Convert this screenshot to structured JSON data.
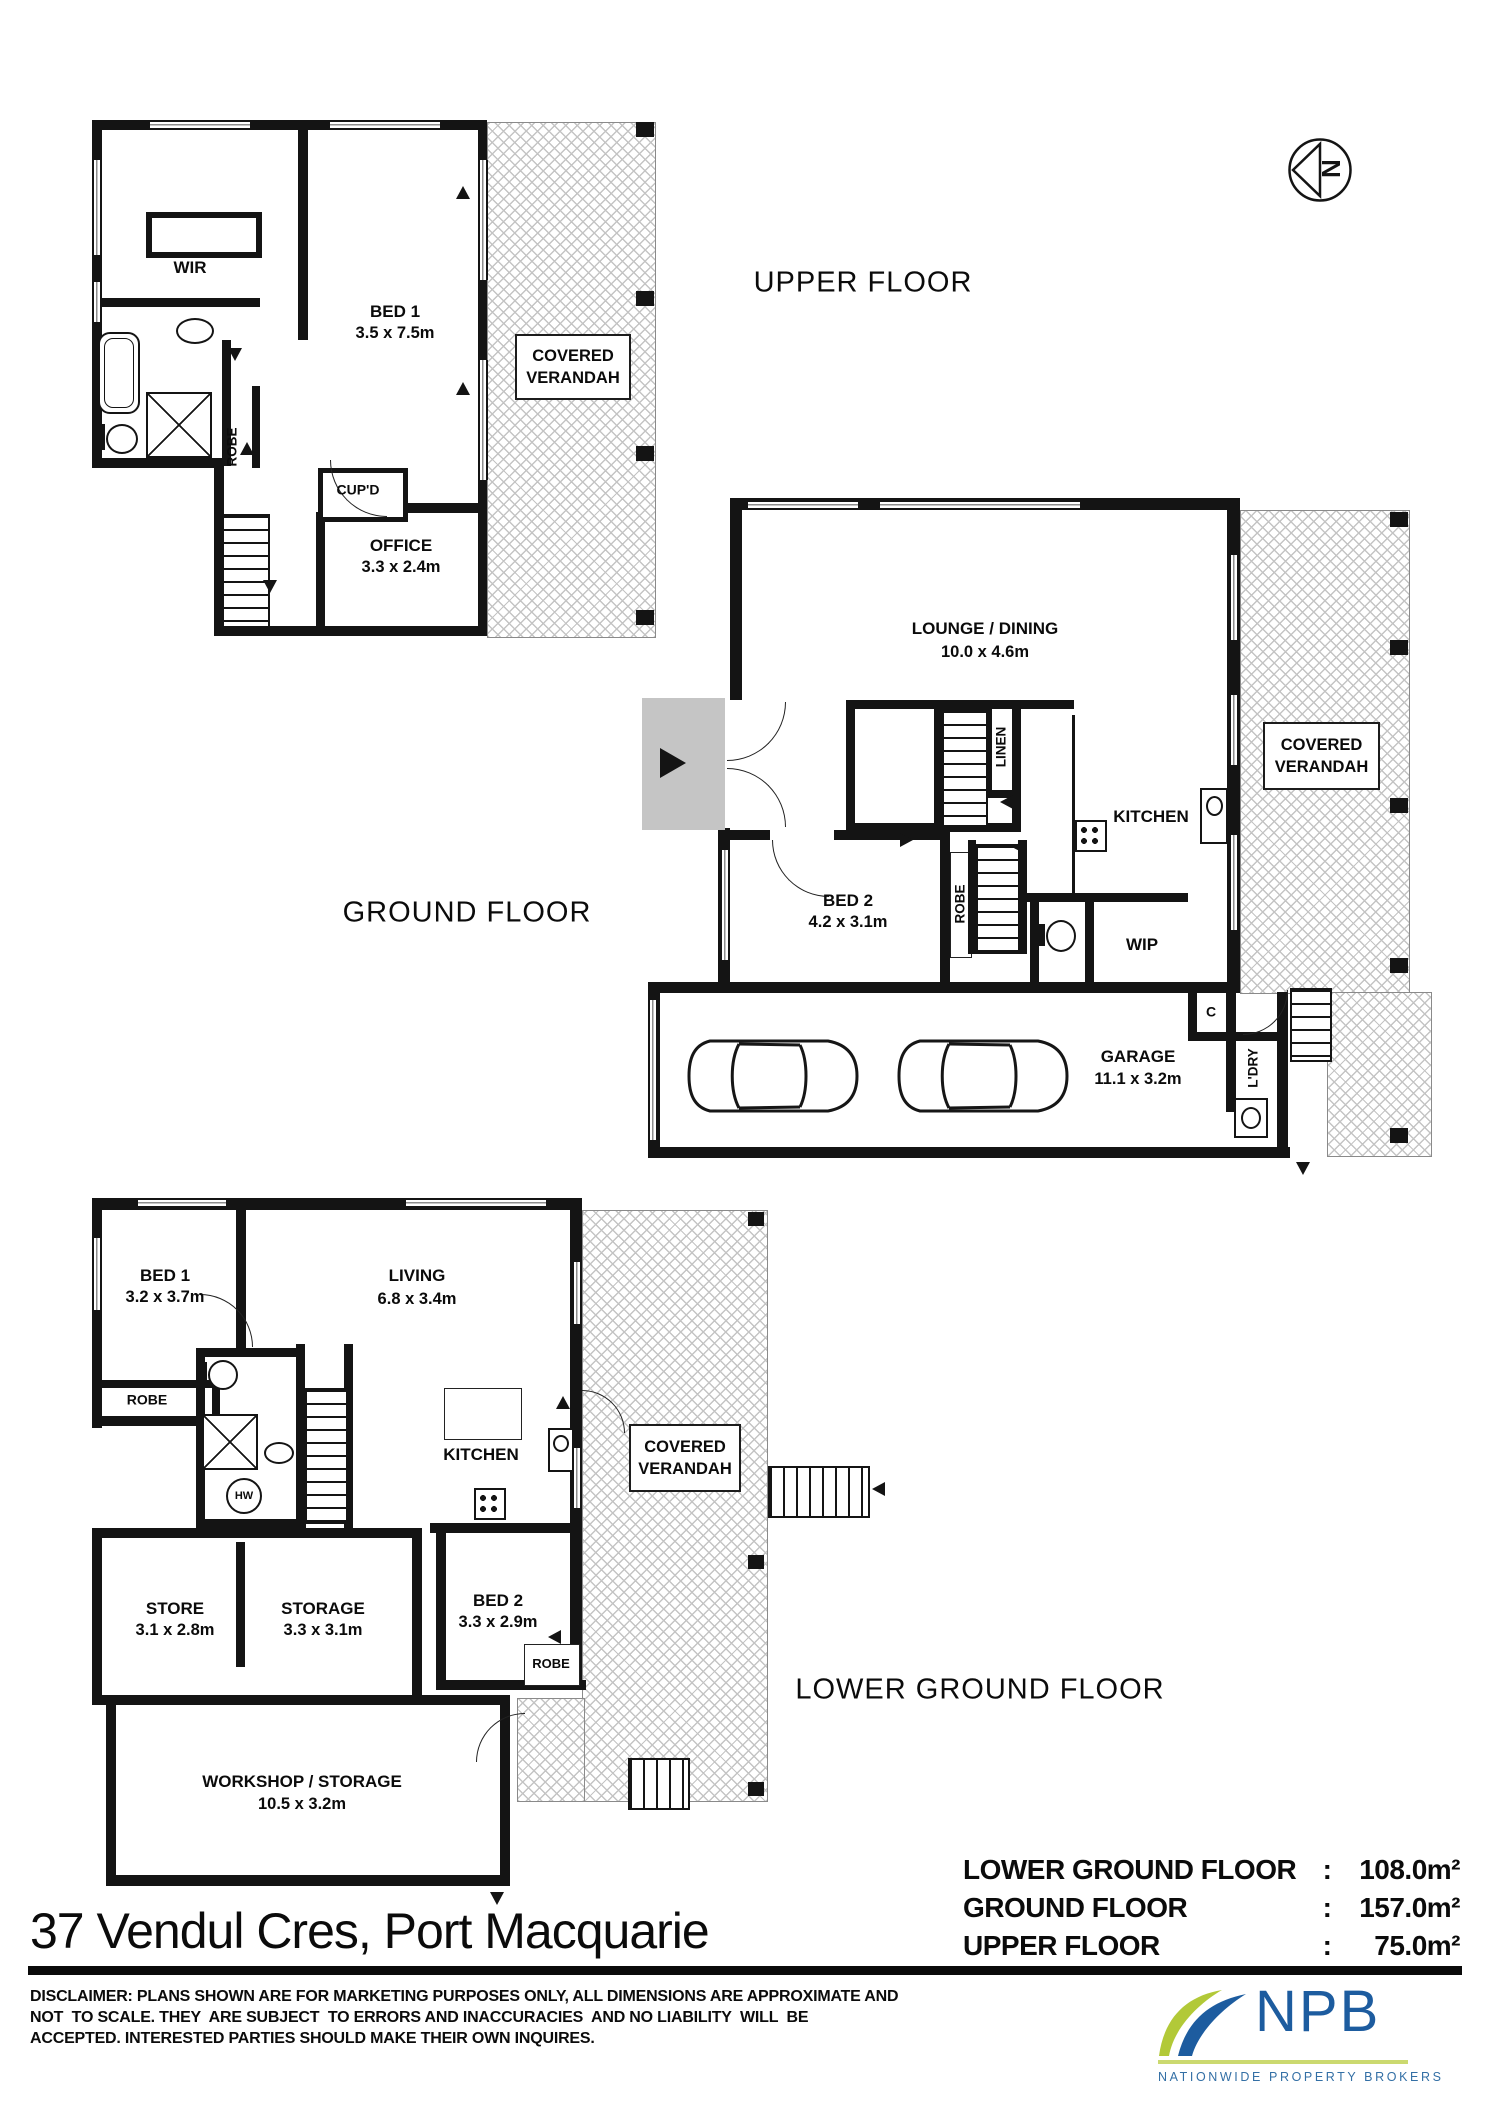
{
  "compass": {
    "north": "N"
  },
  "floors": {
    "upper": {
      "title": "UPPER FLOOR",
      "wir": "WIR",
      "bed1": "BED 1",
      "bed1_dims": "3.5 x 7.5m",
      "robe": "ROBE",
      "cupd": "CUP'D",
      "office": "OFFICE",
      "office_dims": "3.3 x 2.4m",
      "verandah_line1": "COVERED",
      "verandah_line2": "VERANDAH"
    },
    "ground": {
      "title": "GROUND FLOOR",
      "lounge": "LOUNGE / DINING",
      "lounge_dims": "10.0 x 4.6m",
      "linen": "LINEN",
      "kitchen": "KITCHEN",
      "bed2": "BED 2",
      "bed2_dims": "4.2 x 3.1m",
      "robe": "ROBE",
      "wip": "WIP",
      "verandah_line1": "COVERED",
      "verandah_line2": "VERANDAH",
      "garage": "GARAGE",
      "garage_dims": "11.1 x 3.2m",
      "cupboard": "C",
      "laundry": "L'DRY"
    },
    "lower": {
      "title": "LOWER GROUND FLOOR",
      "bed1": "BED 1",
      "bed1_dims": "3.2 x 3.7m",
      "living": "LIVING",
      "living_dims": "6.8 x 3.4m",
      "robe": "ROBE",
      "hot_water": "HW",
      "kitchen": "KITCHEN",
      "verandah_line1": "COVERED",
      "verandah_line2": "VERANDAH",
      "store": "STORE",
      "store_dims": "3.1 x 2.8m",
      "storage": "STORAGE",
      "storage_dims": "3.3 x 3.1m",
      "bed2": "BED 2",
      "bed2_dims": "3.3 x 2.9m",
      "robe2": "ROBE",
      "workshop": "WORKSHOP / STORAGE",
      "workshop_dims": "10.5 x 3.2m"
    }
  },
  "footer": {
    "address": "37 Vendul Cres, Port Macquarie",
    "disclaimer_line1": "DISCLAIMER: PLANS SHOWN ARE FOR MARKETING PURPOSES ONLY, ALL DIMENSIONS ARE APPROXIMATE AND",
    "disclaimer_line2": "NOT  TO SCALE. THEY  ARE SUBJECT  TO ERRORS AND INACCURACIES  AND NO LIABILITY  WILL  BE",
    "disclaimer_line3": "ACCEPTED. INTERESTED PARTIES SHOULD MAKE THEIR OWN INQUIRES.",
    "areas": [
      {
        "label": "LOWER GROUND FLOOR",
        "sep": ":",
        "value": "108.0m²"
      },
      {
        "label": "GROUND FLOOR",
        "sep": ":",
        "value": "157.0m²"
      },
      {
        "label": "UPPER FLOOR",
        "sep": ":",
        "value": "75.0m²"
      }
    ]
  },
  "logo": {
    "initials": "NPB",
    "tagline": "NATIONWIDE PROPERTY BROKERS",
    "colors": {
      "blue": "#1d5c9f",
      "green": "#b2c938",
      "underline": "#cbd96f",
      "tagline_blue": "#336fa5"
    }
  }
}
